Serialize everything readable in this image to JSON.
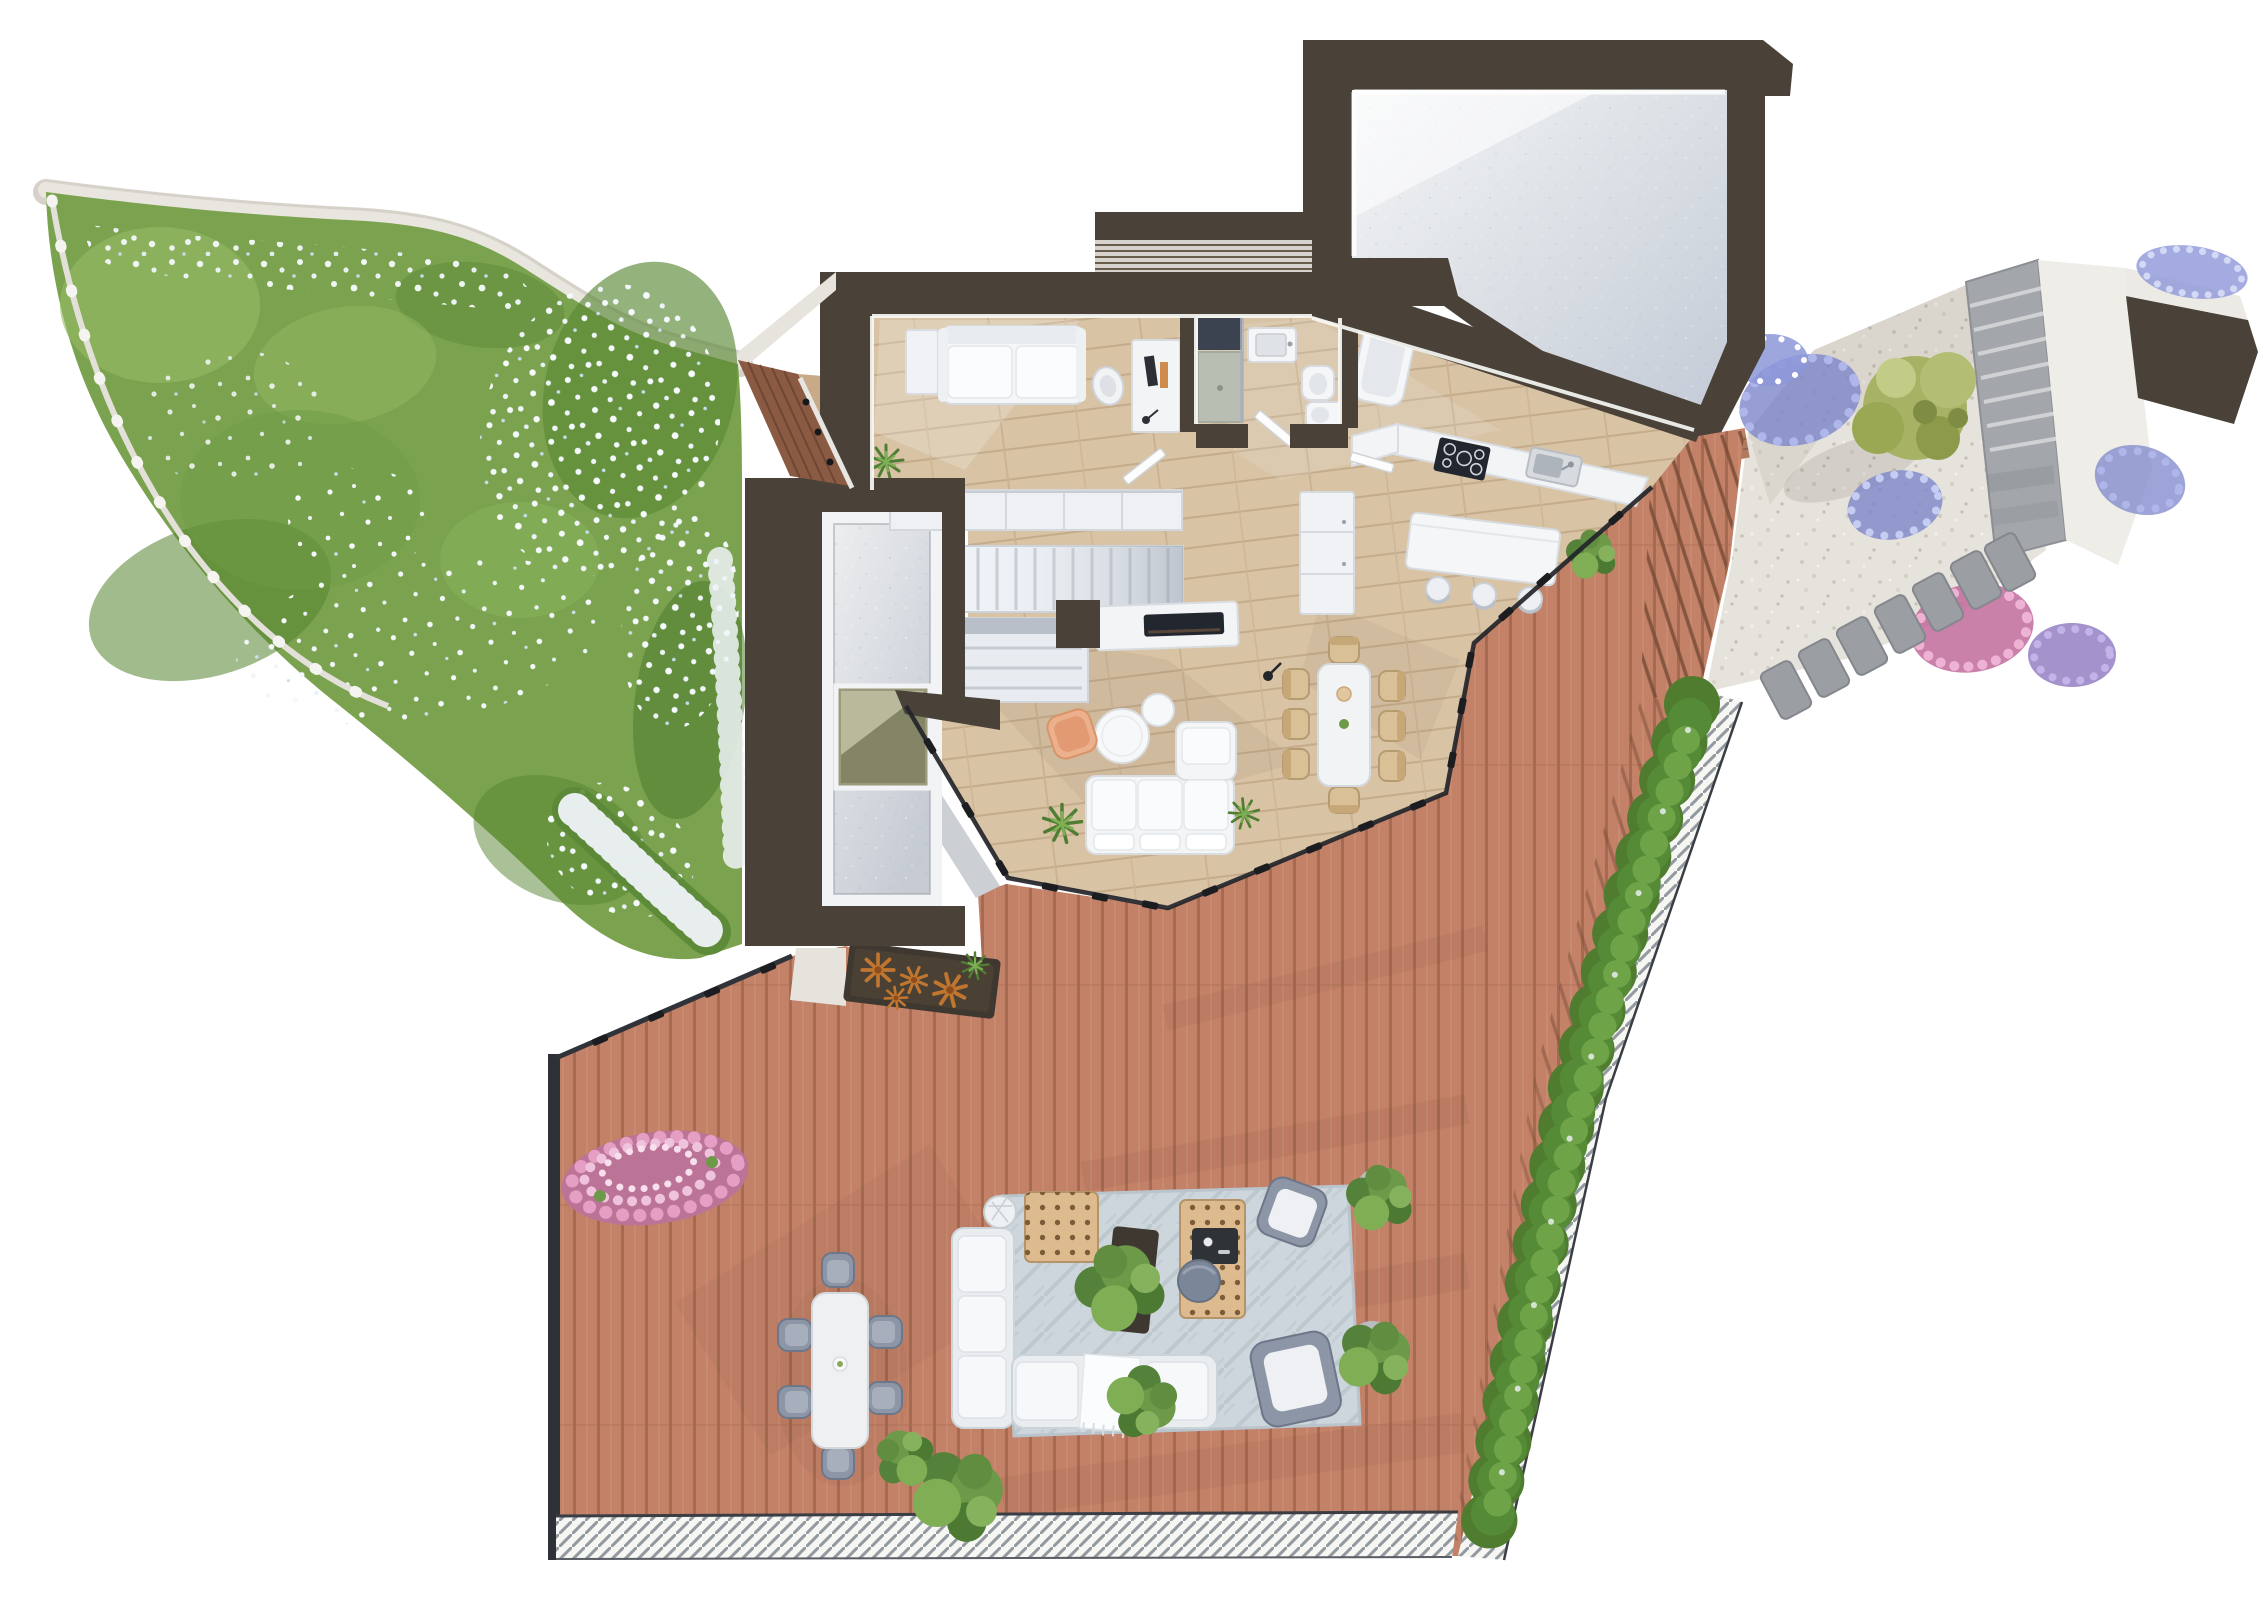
{
  "title": "3D floor plan rendering - top-down view of a house with garden, terrace and garage",
  "type": "architectural-floor-plan-render",
  "colors": {
    "wall": "#4a4238",
    "wood_floor": "#d8c3a5",
    "deck": "#c38168",
    "grass": "#7ba34f",
    "grass_dark": "#5b8836",
    "grass_light": "#96bb66",
    "gravel": "#e6e3dc",
    "stone_wall": "#a3a6aa",
    "plaster": "#eeede8",
    "white_trim": "#f2f3f4",
    "furniture_white": "#f3f5f7",
    "rug": "#cdd6dc",
    "rattan": "#debb8e",
    "hedge": "#4f7c2e",
    "bush_pink": "#bc7398",
    "flowers_purple": "#7d86c9",
    "flowers_white": "#f2f7fb",
    "tree": "#a8b264",
    "accent_chair": "#edb08d",
    "shower_glass": "#3c4350",
    "cooktop": "#22262e",
    "skylight": "#9b9b7c",
    "glass_frame": "#23252a",
    "fence_wood": "#8a5a43",
    "terrace_edge": "#2e3238",
    "concrete_hi": "#f3f4f5",
    "concrete_lo": "#c3cad6"
  },
  "inventory": {
    "indoor_dining_chairs": 8,
    "kitchen_island_stools": 3,
    "outdoor_dining_chairs": 6,
    "stepping_stones": 7,
    "indoor_sofas": 1,
    "outdoor_sofas": 1,
    "coffee_tables_indoor": 2,
    "rattan_tables_outdoor": 2,
    "potted_plants_terrace": 4,
    "bathroom_fixtures": [
      "shower",
      "sink",
      "bidet",
      "toilet",
      "bathtub"
    ]
  },
  "elements": [
    "garden",
    "wildflowers",
    "stone-retaining-wall",
    "garden-fence",
    "house",
    "bedroom",
    "bed",
    "desk",
    "bathroom",
    "ensuite-bathroom",
    "wardrobe",
    "staircase",
    "walk-in-closet",
    "fireplace",
    "kitchen",
    "kitchen-counter",
    "cooktop",
    "kitchen-sink",
    "kitchen-island",
    "dining-table",
    "living-sofa",
    "coffee-tables",
    "accent-chair",
    "light-well",
    "skylight",
    "entry-fence",
    "entry-canopy",
    "garage",
    "gravel-courtyard",
    "stepping-stones",
    "garden-tree",
    "flower-beds",
    "roof-terrace",
    "outdoor-dining-set",
    "outdoor-lounge-set",
    "hedge-row",
    "drainage-grate",
    "aloe-planter",
    "pink-bush",
    "glass-wall"
  ]
}
